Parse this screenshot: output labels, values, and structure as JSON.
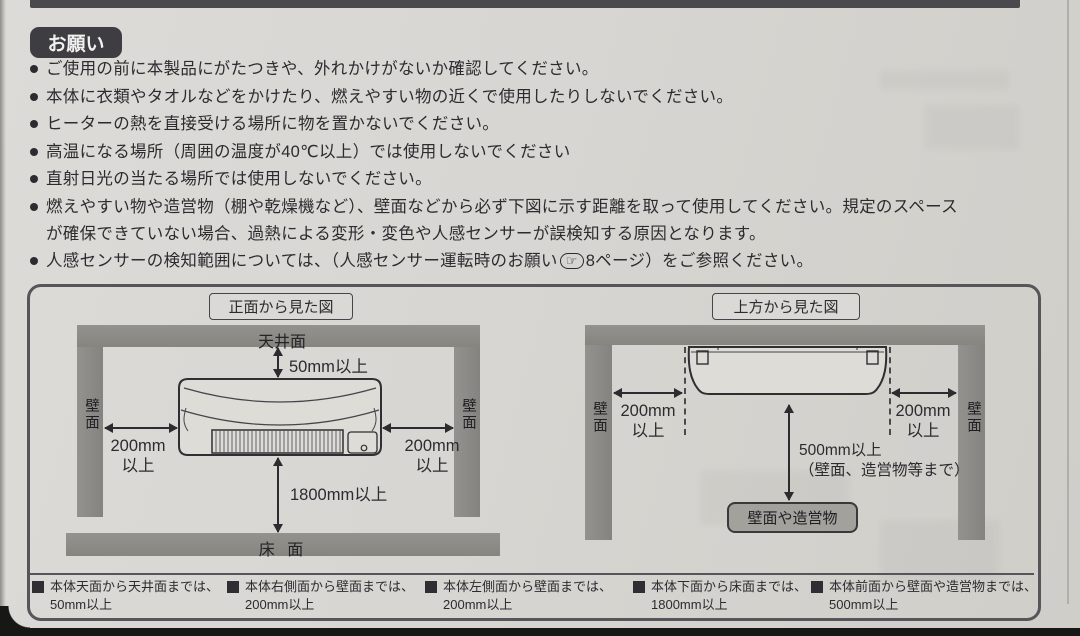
{
  "page": {
    "badge": "お願い",
    "bullets": [
      {
        "text": "ご使用の前に本製品にがたつきや、外れかけがないか確認してください。"
      },
      {
        "text": "本体に衣類やタオルなどをかけたり、燃えやすい物の近くで使用したりしないでください。"
      },
      {
        "text": "ヒーターの熱を直接受ける場所に物を置かないでください。"
      },
      {
        "text": "高温になる場所（周囲の温度が40℃以上）では使用しないでください"
      },
      {
        "text": "直射日光の当たる場所では使用しないでください。"
      },
      {
        "text": "燃えやすい物や造営物（棚や乾燥機など）、壁面などから必ず下図に示す距離を取って使用してください。規定のスペース",
        "text2": "が確保できていない場合、過熱による変形・変色や人感センサーが誤検知する原因となります。"
      },
      {
        "text_before": "人感センサーの検知範囲については、（人感センサー運転時のお願い",
        "icon": "☞",
        "text_after": "8ページ）をご参照ください。"
      }
    ]
  },
  "diagram": {
    "front": {
      "title": "正面から見た図",
      "ceiling_label": "天井面",
      "floor_label": "床 面",
      "wall_label": "壁面",
      "dim_top": "50mm以上",
      "dim_left_value": "200mm",
      "dim_left_unit": "以上",
      "dim_right_value": "200mm",
      "dim_right_unit": "以上",
      "dim_bottom": "1800mm以上"
    },
    "top": {
      "title": "上方から見た図",
      "wall_label": "壁面",
      "dim_left_value": "200mm",
      "dim_left_unit": "以上",
      "dim_right_value": "200mm",
      "dim_right_unit": "以上",
      "dim_front_value": "500mm以上",
      "dim_front_note": "（壁面、造営物等まで）",
      "obstacle_label": "壁面や造営物"
    },
    "legend": [
      {
        "line1": "本体天面から天井面までは、",
        "line2": "50mm以上"
      },
      {
        "line1": "本体右側面から壁面までは、",
        "line2": "200mm以上"
      },
      {
        "line1": "本体左側面から壁面までは、",
        "line2": "200mm以上"
      },
      {
        "line1": "本体下面から床面までは、",
        "line2": "1800mm以上"
      },
      {
        "line1": "本体前面から壁面や造営物までは、",
        "line2": "500mm以上"
      }
    ]
  },
  "colors": {
    "paper": "#d8d6d2",
    "band_gray": "#8d8b87",
    "ink": "#2c2b2f",
    "badge_bg": "#3e3d42",
    "obstacle_bg": "#a3a19c"
  }
}
